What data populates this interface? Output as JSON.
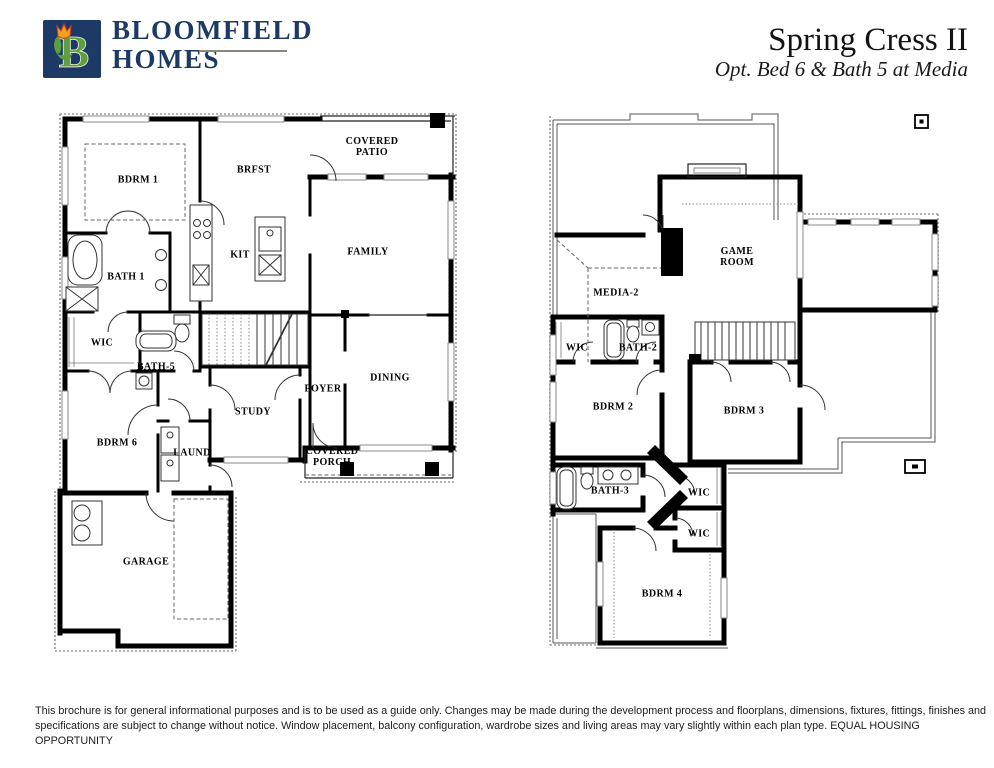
{
  "header": {
    "brand": {
      "line1": "BLOOMFIELD",
      "line2": "HOMES",
      "logo_letter": "B"
    },
    "plan_title": "Spring Cress II",
    "plan_subtitle": "Opt. Bed 6 & Bath 5 at Media"
  },
  "colors": {
    "brand_navy": "#1d3a66",
    "logo_green": "#5f9e3e",
    "logo_tulip_orange": "#f5a01a",
    "logo_tulip_red": "#d23c2a",
    "wall_black": "#000000"
  },
  "floors": {
    "first": {
      "rooms": [
        {
          "id": "bdrm1",
          "label": "BDRM 1"
        },
        {
          "id": "brfst",
          "label": "BRFST"
        },
        {
          "id": "covered-patio",
          "label": "COVERED\nPATIO"
        },
        {
          "id": "family",
          "label": "FAMILY"
        },
        {
          "id": "kit",
          "label": "KIT"
        },
        {
          "id": "bath1",
          "label": "BATH 1"
        },
        {
          "id": "wic",
          "label": "WIC"
        },
        {
          "id": "bath5",
          "label": "BATH-5"
        },
        {
          "id": "bdrm6",
          "label": "BDRM 6"
        },
        {
          "id": "laund",
          "label": "LAUND"
        },
        {
          "id": "study",
          "label": "STUDY"
        },
        {
          "id": "foyer",
          "label": "FOYER"
        },
        {
          "id": "dining",
          "label": "DINING"
        },
        {
          "id": "covered-porch",
          "label": "COVERED\nPORCH"
        },
        {
          "id": "garage",
          "label": "GARAGE"
        }
      ]
    },
    "second": {
      "rooms": [
        {
          "id": "media2",
          "label": "MEDIA-2"
        },
        {
          "id": "game-room",
          "label": "GAME\nROOM"
        },
        {
          "id": "wic-a",
          "label": "WIC"
        },
        {
          "id": "bath2",
          "label": "BATH-2"
        },
        {
          "id": "bdrm2",
          "label": "BDRM 2"
        },
        {
          "id": "bdrm3",
          "label": "BDRM 3"
        },
        {
          "id": "bath3",
          "label": "BATH-3"
        },
        {
          "id": "wic-b",
          "label": "WIC"
        },
        {
          "id": "wic-c",
          "label": "WIC"
        },
        {
          "id": "bdrm4",
          "label": "BDRM 4"
        }
      ]
    }
  },
  "footer": {
    "disclaimer": "This brochure is for general informational purposes and is to be used as a guide only. Changes may be made during the development process and floorplans, dimensions, fixtures, fittings, finishes and specifications are subject to change without notice. Window placement, balcony configuration, wardrobe sizes and living areas may vary slightly within each plan type.  EQUAL HOUSING OPPORTUNITY"
  }
}
